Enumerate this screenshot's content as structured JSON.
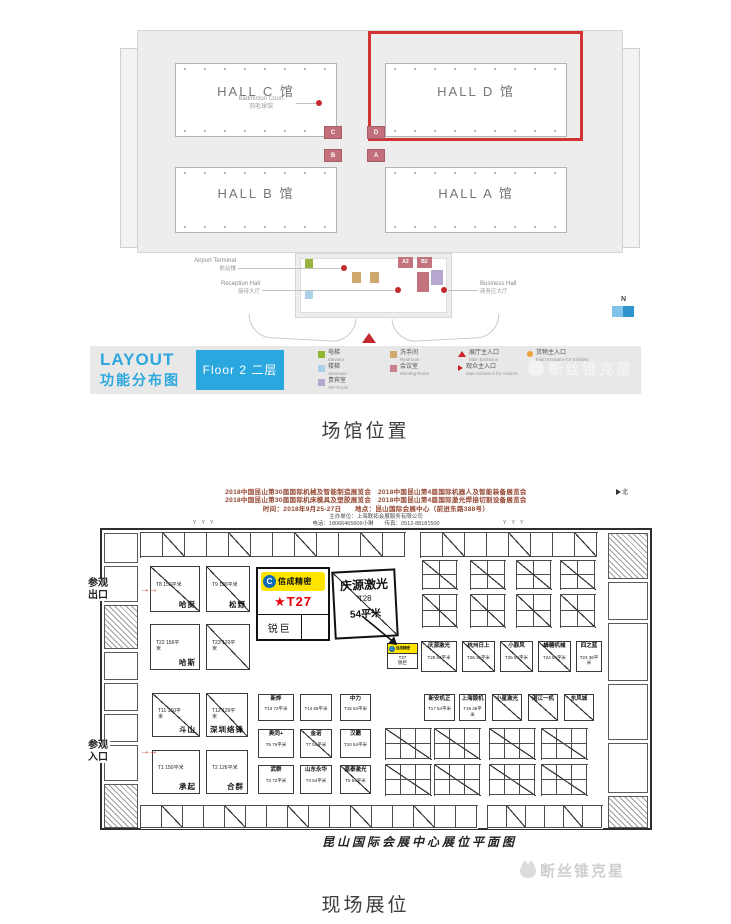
{
  "captions": {
    "top": "场馆位置",
    "bottom": "现场展位"
  },
  "venue_map": {
    "halls": [
      {
        "label": "HALL C 馆",
        "sub_en": "Badminton Court",
        "sub_cn": "羽毛球馆"
      },
      {
        "label": "HALL D 馆"
      },
      {
        "label": "HALL B 馆"
      },
      {
        "label": "HALL A 馆"
      }
    ],
    "connectors": [
      "C",
      "D",
      "B",
      "A"
    ],
    "podium_rooms": [
      "A2",
      "B2"
    ],
    "annotations": {
      "airport_en": "Airport Terminal",
      "airport_cn": "航站楼",
      "reception_en": "Reception Hall",
      "reception_cn": "接待大厅",
      "business_en": "Business Hall",
      "business_cn": "商务区大厅"
    },
    "compass_n": "N",
    "legend": {
      "title_en": "LAYOUT",
      "title_cn": "功能分布图",
      "floor_label": "Floor 2 二层",
      "items": [
        {
          "cn": "电梯",
          "en": "Elevator",
          "color": "#8fb832",
          "shape": "square"
        },
        {
          "cn": "楼梯",
          "en": "Staircase",
          "color": "#a9d2e8",
          "shape": "square"
        },
        {
          "cn": "贵宾室",
          "en": "VIP Room",
          "color": "#b5a7ce",
          "shape": "square"
        },
        {
          "cn": "洗手间",
          "en": "Restroom",
          "color": "#d0a76f",
          "shape": "square"
        },
        {
          "cn": "会议室",
          "en": "Meeting Room",
          "color": "#c8828c",
          "shape": "square"
        },
        {
          "cn": "展厅主入口",
          "en": "Main Entrance",
          "color": "#c9252b",
          "shape": "triangle"
        },
        {
          "cn": "观众主入口",
          "en": "Main Entrance for Visitors",
          "color": "#c9252b",
          "shape": "arrow"
        },
        {
          "cn": "货物主入口",
          "en": "Main Entrance for Exhibits",
          "color": "#e8a33d",
          "shape": "dot"
        }
      ]
    },
    "watermark": "断丝锥克星"
  },
  "booth_map": {
    "header": {
      "line1": "2018中国昆山第30届国际机械及智能制造展览会　2018中国昆山第4届国际机器人及智能装备展览会",
      "line2": "2018中国昆山第30届国际机床模具及塑胶展览会　2018中国昆山第4届国际激光焊接切割设备展览会",
      "line3": "时间：2018年9月25-27日　　地点：昆山国际会展中心（前进东路388号）",
      "line4": "主办单位：上海联拓会展服务有限公司",
      "line5": "电话：18066465606小琳　　传真：0512-88181500"
    },
    "north_label": "北",
    "truss_marks": "Y Y Y",
    "exit_label": "参观出口",
    "entrance_label": "参观入口",
    "arrows": "→→",
    "callout": {
      "brand": "信成精密",
      "booth_no": "★T27",
      "company": "锐巨"
    },
    "featured": {
      "company": "庆源激光",
      "booth_no": "T28",
      "area": "54平米"
    },
    "mini_booth": {
      "brand": "信成精密",
      "booth_no": "T27",
      "company": "锐巨"
    },
    "booths": [
      {
        "label": "哈挺",
        "sub": "T8 150平米",
        "x": 150,
        "y": 566,
        "w": 50,
        "h": 46,
        "diag": true,
        "big": true
      },
      {
        "label": "松野",
        "sub": "T9 120平米",
        "x": 206,
        "y": 566,
        "w": 44,
        "h": 46,
        "diag": true,
        "big": true
      },
      {
        "label": "哈斯",
        "sub": "T22 156平米",
        "x": 150,
        "y": 624,
        "w": 50,
        "h": 46,
        "big": true
      },
      {
        "label": "",
        "sub": "T23 120平米",
        "x": 206,
        "y": 624,
        "w": 44,
        "h": 46,
        "diag": true,
        "big": true
      },
      {
        "label": "斗山",
        "sub": "T11 150平米",
        "x": 152,
        "y": 693,
        "w": 48,
        "h": 44,
        "diag": true,
        "big": true
      },
      {
        "label": "深圳络锋",
        "sub": "T12 126平米",
        "x": 206,
        "y": 693,
        "w": 42,
        "h": 44,
        "diag": true,
        "big": true
      },
      {
        "label": "承起",
        "sub": "T1 150平米",
        "x": 152,
        "y": 750,
        "w": 48,
        "h": 44,
        "big": true
      },
      {
        "label": "合群",
        "sub": "T2 126平米",
        "x": 206,
        "y": 750,
        "w": 42,
        "h": 44,
        "big": true
      },
      {
        "label": "新烨",
        "sub": "T13 72平米",
        "x": 258,
        "y": 694,
        "w": 36,
        "h": 27
      },
      {
        "label": "",
        "sub": "T14 65平米",
        "x": 300,
        "y": 694,
        "w": 32,
        "h": 27
      },
      {
        "label": "中力",
        "sub": "T15 54平米",
        "x": 340,
        "y": 694,
        "w": 31,
        "h": 27
      },
      {
        "label": "新安机正",
        "sub": "T17 54平米",
        "x": 424,
        "y": 694,
        "w": 31,
        "h": 27
      },
      {
        "label": "上海锻机",
        "sub": "T18 36平米",
        "x": 459,
        "y": 694,
        "w": 27,
        "h": 27
      },
      {
        "label": "小星激光",
        "sub": "",
        "x": 492,
        "y": 694,
        "w": 30,
        "h": 27,
        "diag": true
      },
      {
        "label": "湛江一机",
        "sub": "",
        "x": 528,
        "y": 694,
        "w": 30,
        "h": 27,
        "diag": true
      },
      {
        "label": "东风城",
        "sub": "",
        "x": 564,
        "y": 694,
        "w": 30,
        "h": 27,
        "diag": true
      },
      {
        "label": "奥同+",
        "sub": "T6 76平米",
        "x": 258,
        "y": 729,
        "w": 36,
        "h": 29
      },
      {
        "label": "金诺",
        "sub": "T7 54平米",
        "x": 300,
        "y": 729,
        "w": 32,
        "h": 29,
        "diag": true
      },
      {
        "label": "汉霸",
        "sub": "T10 54平米",
        "x": 340,
        "y": 729,
        "w": 31,
        "h": 29
      },
      {
        "label": "武群",
        "sub": "T3 72平米",
        "x": 258,
        "y": 765,
        "w": 36,
        "h": 29
      },
      {
        "label": "山东永华",
        "sub": "T4 54平米",
        "x": 300,
        "y": 765,
        "w": 32,
        "h": 29
      },
      {
        "label": "嘉泰激光",
        "sub": "T5 54平米",
        "x": 340,
        "y": 765,
        "w": 31,
        "h": 29,
        "diag": true
      },
      {
        "label": "庆源激光",
        "sub": "T28 54平米",
        "x": 421,
        "y": 641,
        "w": 36,
        "h": 31,
        "diag": true
      },
      {
        "label": "杭州日上",
        "sub": "T26 36平米",
        "x": 462,
        "y": 641,
        "w": 33,
        "h": 31,
        "diag": true
      },
      {
        "label": "小豚风",
        "sub": "T25 54平米",
        "x": 500,
        "y": 641,
        "w": 33,
        "h": 31,
        "diag": true
      },
      {
        "label": "蜂糖机械",
        "sub": "T24 54平米",
        "x": 538,
        "y": 641,
        "w": 33,
        "h": 31,
        "diag": true
      },
      {
        "label": "四之蓝",
        "sub": "T23 36平米",
        "x": 576,
        "y": 641,
        "w": 26,
        "h": 31
      }
    ],
    "clusters": [
      {
        "x": 140,
        "y": 532,
        "cols": 12,
        "rows": 1,
        "cw": 22,
        "ch": 24
      },
      {
        "x": 420,
        "y": 532,
        "cols": 8,
        "rows": 1,
        "cw": 22,
        "ch": 24
      },
      {
        "x": 422,
        "y": 560,
        "cols": 2,
        "rows": 2,
        "cw": 17,
        "ch": 14
      },
      {
        "x": 470,
        "y": 560,
        "cols": 2,
        "rows": 2,
        "cw": 17,
        "ch": 14
      },
      {
        "x": 516,
        "y": 560,
        "cols": 2,
        "rows": 2,
        "cw": 17,
        "ch": 14
      },
      {
        "x": 560,
        "y": 560,
        "cols": 2,
        "rows": 2,
        "cw": 17,
        "ch": 14
      },
      {
        "x": 422,
        "y": 594,
        "cols": 2,
        "rows": 2,
        "cw": 17,
        "ch": 16
      },
      {
        "x": 470,
        "y": 594,
        "cols": 2,
        "rows": 2,
        "cw": 17,
        "ch": 16
      },
      {
        "x": 516,
        "y": 594,
        "cols": 2,
        "rows": 2,
        "cw": 17,
        "ch": 16
      },
      {
        "x": 560,
        "y": 594,
        "cols": 2,
        "rows": 2,
        "cw": 17,
        "ch": 16
      },
      {
        "x": 385,
        "y": 728,
        "cols": 3,
        "rows": 2,
        "cw": 15,
        "ch": 15
      },
      {
        "x": 434,
        "y": 728,
        "cols": 3,
        "rows": 2,
        "cw": 15,
        "ch": 15
      },
      {
        "x": 489,
        "y": 728,
        "cols": 3,
        "rows": 2,
        "cw": 15,
        "ch": 15
      },
      {
        "x": 541,
        "y": 728,
        "cols": 3,
        "rows": 2,
        "cw": 15,
        "ch": 15
      },
      {
        "x": 385,
        "y": 764,
        "cols": 3,
        "rows": 2,
        "cw": 15,
        "ch": 15
      },
      {
        "x": 434,
        "y": 764,
        "cols": 3,
        "rows": 2,
        "cw": 15,
        "ch": 15
      },
      {
        "x": 489,
        "y": 764,
        "cols": 3,
        "rows": 2,
        "cw": 15,
        "ch": 15
      },
      {
        "x": 541,
        "y": 764,
        "cols": 3,
        "rows": 2,
        "cw": 15,
        "ch": 15
      },
      {
        "x": 140,
        "y": 805,
        "cols": 16,
        "rows": 1,
        "cw": 21,
        "ch": 22
      },
      {
        "x": 487,
        "y": 805,
        "cols": 6,
        "rows": 1,
        "cw": 19,
        "ch": 22
      }
    ],
    "corridor_left": [
      {
        "y": 533,
        "h": 30
      },
      {
        "y": 566,
        "h": 36
      },
      {
        "y": 605,
        "h": 44,
        "hatch": true
      },
      {
        "y": 652,
        "h": 28
      },
      {
        "y": 683,
        "h": 28
      },
      {
        "y": 714,
        "h": 28
      },
      {
        "y": 745,
        "h": 36
      },
      {
        "y": 784,
        "h": 44,
        "hatch": true
      }
    ],
    "corridor_right": [
      {
        "y": 533,
        "h": 46,
        "hatch": true
      },
      {
        "y": 582,
        "h": 38
      },
      {
        "y": 623,
        "h": 58
      },
      {
        "y": 684,
        "h": 56
      },
      {
        "y": 743,
        "h": 50
      },
      {
        "y": 796,
        "h": 32,
        "hatch": true
      }
    ],
    "title": "昆山国际会展中心展位平面图",
    "watermark": "断丝锥克星"
  }
}
